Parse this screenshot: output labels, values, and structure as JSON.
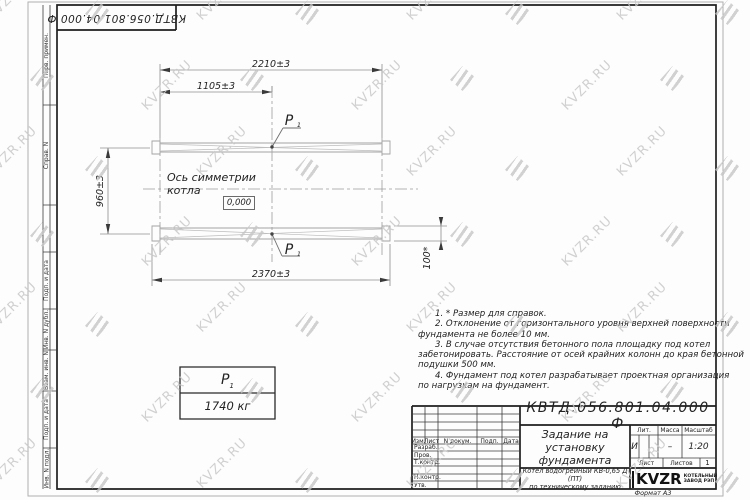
{
  "sheet": {
    "corner_stamp": "КВТД.056.801.04.000 Ф",
    "format_label": "Формат А3"
  },
  "watermark": {
    "text": "KVZR.RU"
  },
  "frame_strip": {
    "labels": [
      "Перв. примен.",
      "Справ. N",
      "Подп. и дата",
      "Инв. N дубл.",
      "Взам. инв. N",
      "Подп. и дата",
      "Инв. N подл."
    ]
  },
  "drawing": {
    "dims": {
      "overall_top": "2210±3",
      "half_top": "1105±3",
      "left": "960±3",
      "bottom": "2370±3",
      "right": "100*"
    },
    "axis_label": "Ось симметрии котла",
    "level_mark": "0,000",
    "load_point": {
      "sym": "Р",
      "sub": "1"
    },
    "load_table": {
      "sym": "Р",
      "sub": "1",
      "value": "1740 кг"
    }
  },
  "notes": {
    "lines": [
      "1. * Размер для справок.",
      "2. Отклонение от горизонтального уровня верхней поверхности",
      "фундамента не более 10 мм.",
      "3. В случае отсутствия бетонного пола площадку под котел",
      "забетонировать. Расстояние от осей крайних колонн до края бетонной",
      "подушки 500 мм.",
      "4. Фундамент под котел разрабатывает проектная организация",
      "по нагрузкам на фундамент."
    ]
  },
  "title_block": {
    "doc_number": "КВТД.056.801.04.000 Ф",
    "title_lines": [
      "Задание на",
      "установку",
      "фундамента"
    ],
    "product_lines": [
      "Котел водогрейный КВ-0,65 Д (ПТ)",
      "по техническому заданию"
    ],
    "header_cols": [
      "Изм.",
      "Лист",
      "N докум.",
      "Подп.",
      "Дата"
    ],
    "row_labels": [
      "Разраб.",
      "Пров.",
      "Т.контр.",
      "Н.контр.",
      "Утв."
    ],
    "lit_label": "Лит.",
    "lit_value": "И",
    "mass_label": "Масса",
    "mass_value": "–",
    "scale_label": "Масштаб",
    "scale_value": "1:20",
    "sheet_label": "Лист",
    "sheets_label": "Листов",
    "sheets_value": "1",
    "logo_text": "KVZR",
    "logo_caption_lines": [
      "КОТЕЛЬНЫЙ",
      "ЗАВОД РЭП"
    ]
  }
}
